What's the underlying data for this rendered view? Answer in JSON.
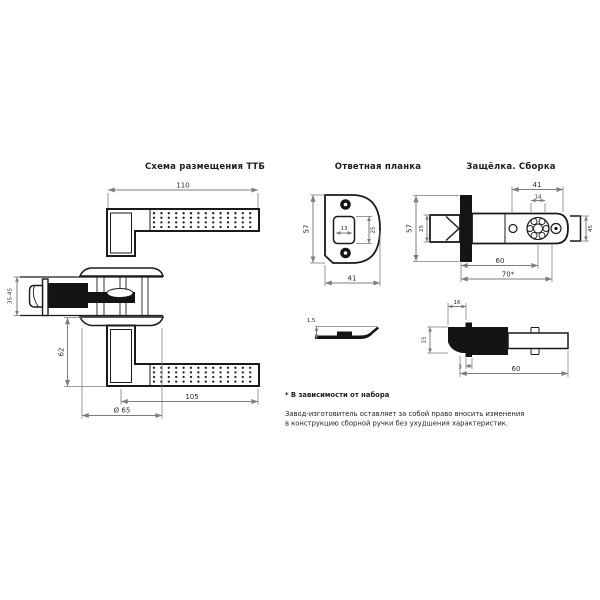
{
  "colors": {
    "background": "#ffffff",
    "outline": "#1a1a1a",
    "dimension_lines": "#7d7d7d",
    "text": "#2a2a2a"
  },
  "views": {
    "handle_top": {
      "title": "Схема размещения ТТБ",
      "dims": {
        "lever_length": "110",
        "door_thickness": "35-45",
        "height": "62",
        "lever_reach": "105",
        "rose_diameter": "Ø 65"
      }
    },
    "strike_plate": {
      "title": "Ответная планка",
      "dims": {
        "height": "57",
        "width": "41",
        "opening_width": "13",
        "opening_height": "25"
      }
    },
    "latch_assembly": {
      "title": "Защёлка. Сборка",
      "dims": {
        "faceplate_height": "57",
        "bolt_height": "25",
        "case_length": "41",
        "hub_width": "14",
        "hub_height": "45",
        "backset_main": "60",
        "backset_alt": "70*"
      }
    },
    "strike_plate_profile": {
      "dims": {
        "bend_height": "1,5"
      }
    },
    "latch_profile": {
      "dims": {
        "bolt_width": "16",
        "bolt_height": "15",
        "faceplate_offset": "3",
        "case_length": "60"
      }
    }
  },
  "notes": {
    "footnote": "* В зависимости от набора",
    "disclaimer_line1": "Завод-изготовитель оставляет за собой право вносить изменения",
    "disclaimer_line2": "в конструкцию сборной ручки без ухудшения характеристик."
  }
}
